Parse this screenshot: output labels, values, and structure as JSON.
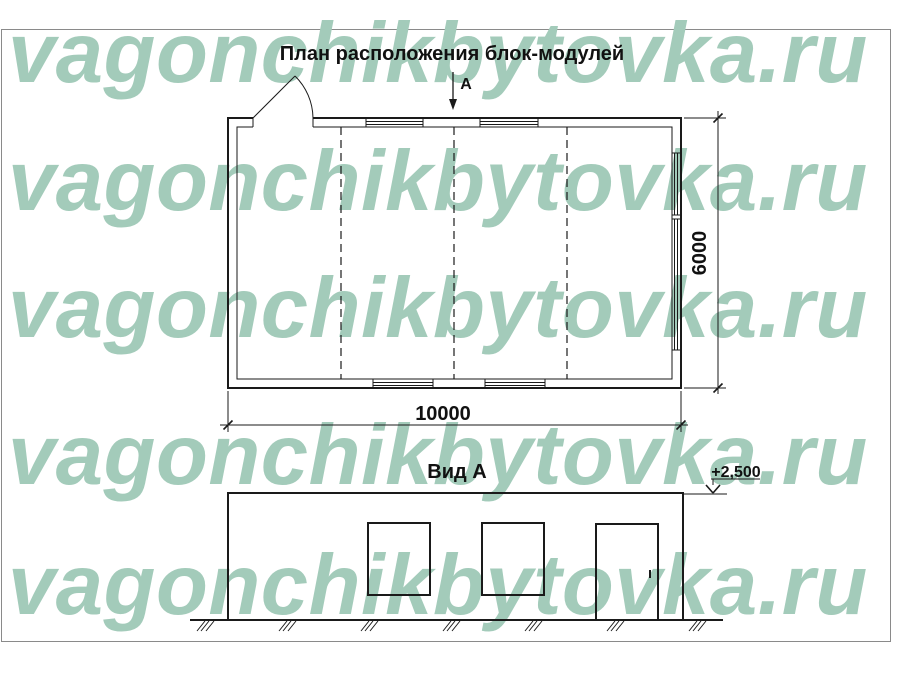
{
  "watermark": {
    "text": "vagonchikbytovka.ru",
    "color": "#a3cbba",
    "rows": 5
  },
  "plan": {
    "title": "План расположения блок-модулей",
    "section_label": "А",
    "length_dim": "10000",
    "width_dim": "6000"
  },
  "elevation": {
    "title": "Вид А",
    "level_mark": "+2,500"
  },
  "drawing": {
    "line_color": "#1a1a1a",
    "modules_count": 4,
    "plan_windows_front": 2,
    "plan_windows_side": 2,
    "elevation_windows": 2,
    "elevation_doors": 1
  }
}
